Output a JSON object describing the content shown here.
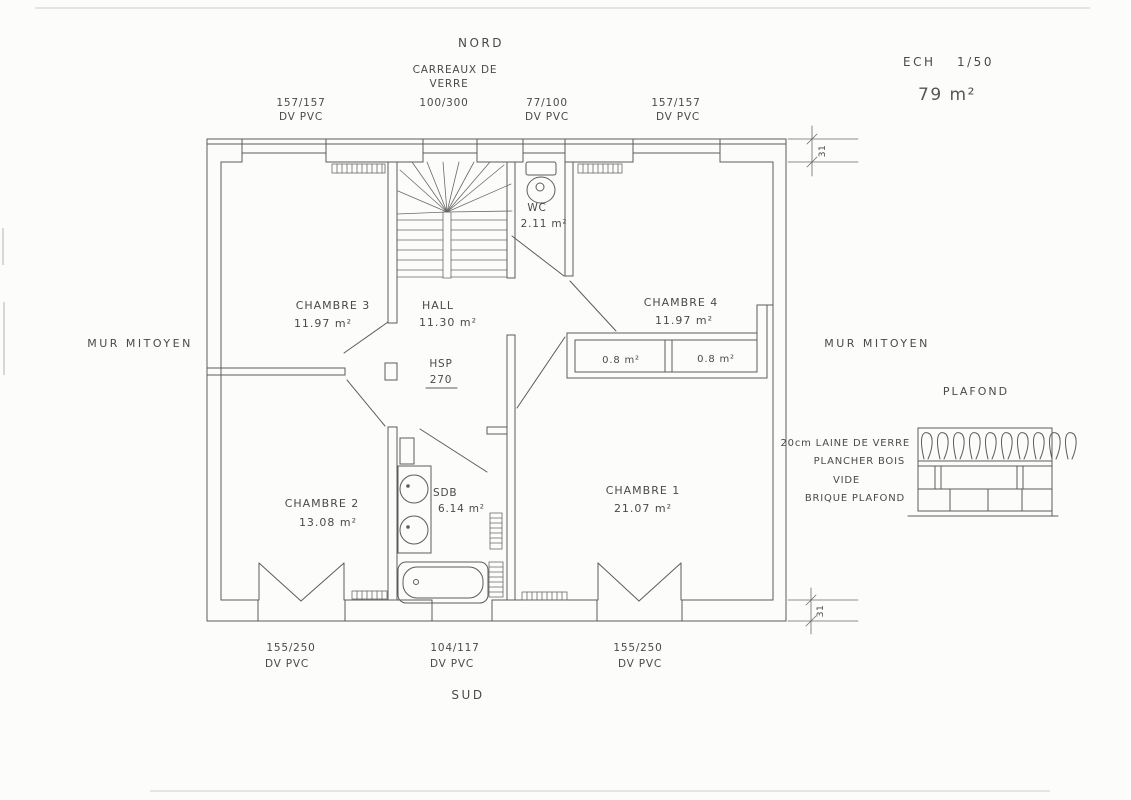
{
  "compass": {
    "north": "NORD",
    "south": "SUD"
  },
  "title_block": {
    "scale_label": "ECH",
    "scale_value": "1/50",
    "total_area": "79 m²"
  },
  "party_wall_left": "MUR MITOYEN",
  "party_wall_right": "MUR MITOYEN",
  "windows_top": [
    {
      "size": "157/157",
      "type": "DV PVC"
    },
    {
      "size": "100/300",
      "material_line1": "CARREAUX DE",
      "material_line2": "VERRE"
    },
    {
      "size": "77/100",
      "type": "DV PVC"
    },
    {
      "size": "157/157",
      "type": "DV PVC"
    }
  ],
  "windows_bottom": [
    {
      "size": "155/250",
      "type": "DV PVC"
    },
    {
      "size": "104/117",
      "type": "DV PVC"
    },
    {
      "size": "155/250",
      "type": "DV PVC"
    }
  ],
  "rooms": {
    "chambre3": {
      "name": "CHAMBRE 3",
      "area": "11.97 m²"
    },
    "hall": {
      "name": "HALL",
      "area": "11.30 m²"
    },
    "wc": {
      "name": "WC",
      "area": "2.11 m²"
    },
    "chambre4": {
      "name": "CHAMBRE 4",
      "area": "11.97 m²"
    },
    "chambre2": {
      "name": "CHAMBRE 2",
      "area": "13.08 m²"
    },
    "sdb": {
      "name": "SDB",
      "area": "6.14 m²"
    },
    "chambre1": {
      "name": "CHAMBRE 1",
      "area": "21.07 m²"
    }
  },
  "closets": {
    "left": "0.8 m²",
    "right": "0.8 m²"
  },
  "ceiling_height": {
    "label": "HSP",
    "value": "270"
  },
  "wall_dims": {
    "top": "31",
    "bottom": "31"
  },
  "ceiling_detail": {
    "title": "PLAFOND",
    "layer1": "20cm LAINE DE VERRE",
    "layer2": "PLANCHER BOIS",
    "layer3": "VIDE",
    "layer4": "BRIQUE PLAFOND"
  },
  "colors": {
    "pencil": "#5c5c5c",
    "text": "#4a4a4a",
    "paper": "#fcfcfb"
  }
}
